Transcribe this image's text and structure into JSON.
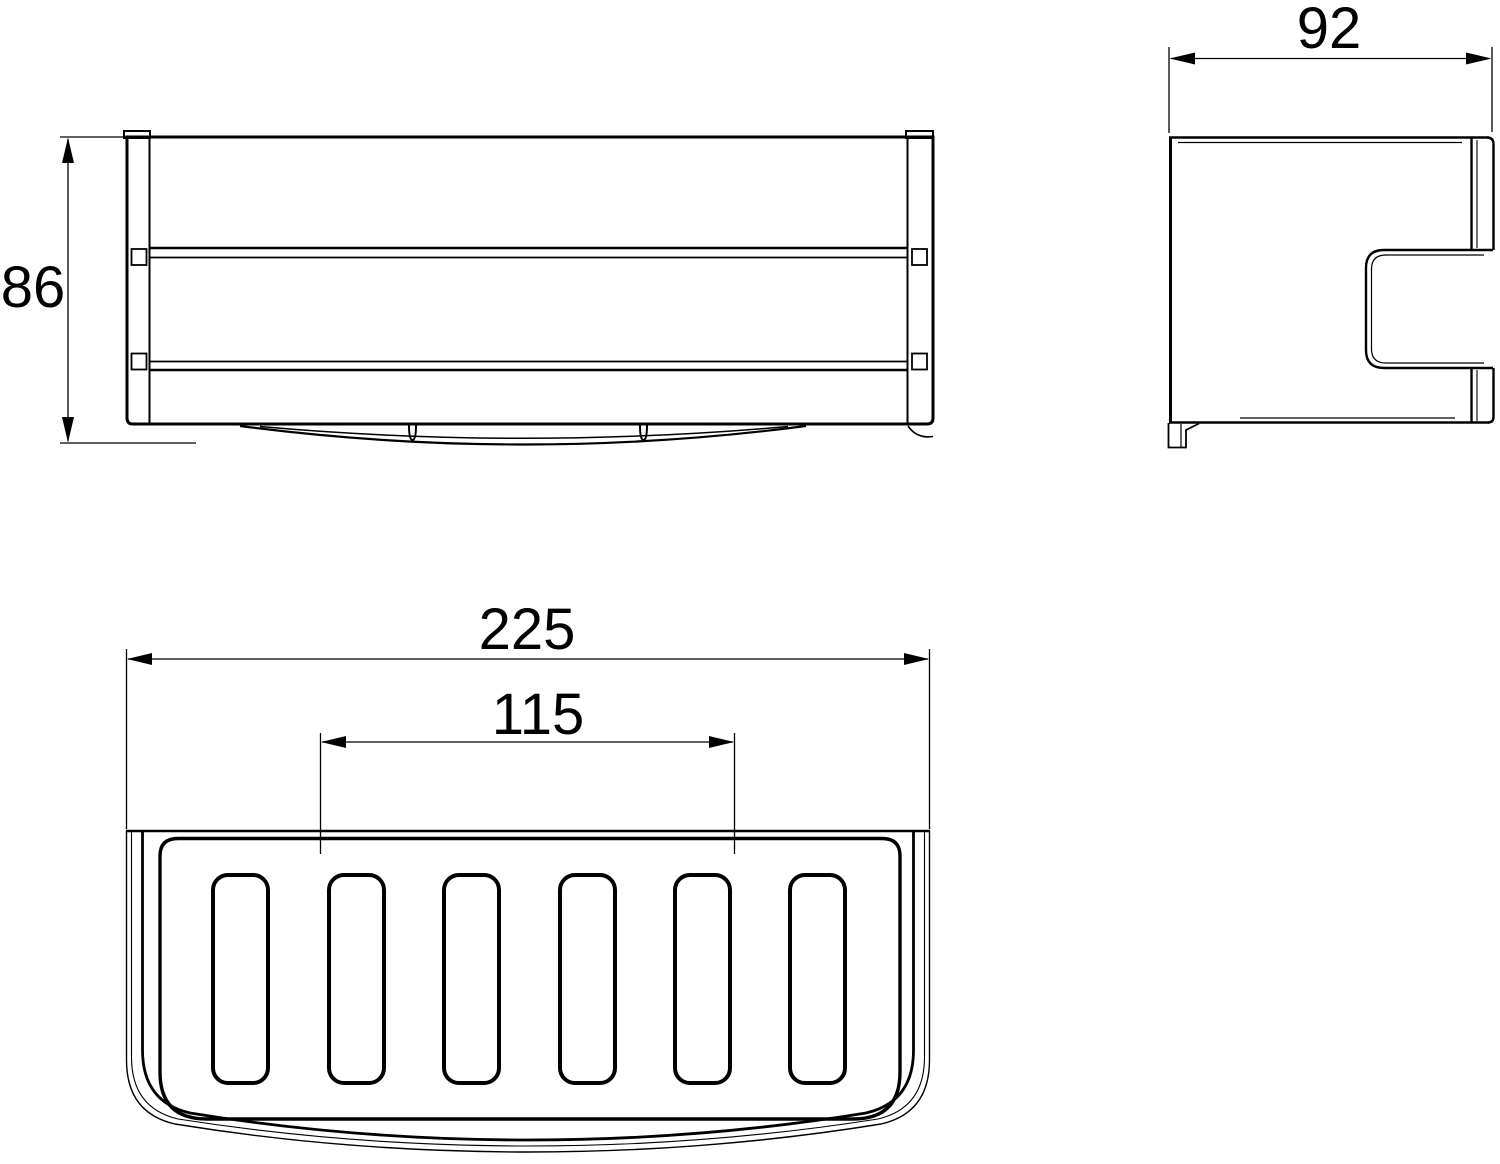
{
  "drawing": {
    "type": "technical-dimension-drawing",
    "object": "wall-mounted wire basket, three orthographic views",
    "ink_color": "#000000",
    "background_color": "#ffffff",
    "dimensions": {
      "height": "86",
      "depth": "92",
      "width": "225",
      "inner_spacing": "115"
    }
  }
}
